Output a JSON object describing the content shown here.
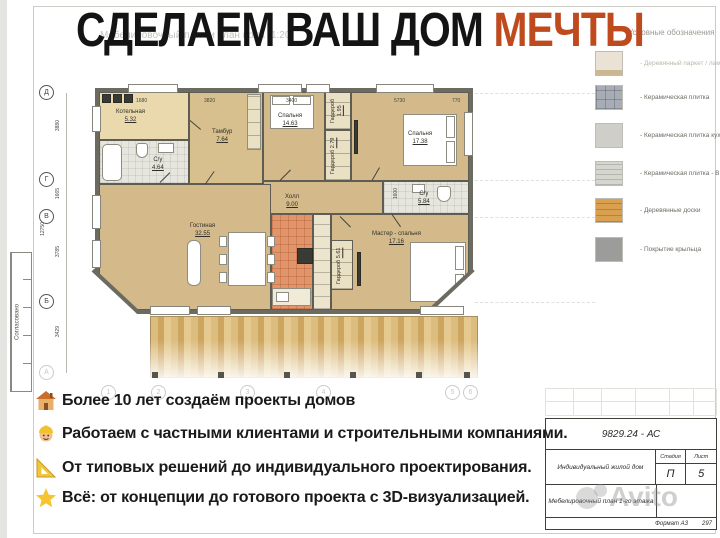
{
  "title": {
    "main": "СДЕЛАЕМ ВАШ ДОМ ",
    "accent": "МЕЧТЫ"
  },
  "drawing_caption": "Мебелировочный план и план пола (1:20)",
  "legend": {
    "header": "Условные обозначения",
    "items": [
      {
        "label": "- Деревянный паркет / ламинат",
        "color": "#eae2d4"
      },
      {
        "label": "- Керамическая плитка",
        "color": "#a8adb5"
      },
      {
        "label": "- Керамическая плитка кухонная",
        "color": "#cfcec9"
      },
      {
        "label": "- Керамическая плитка - В с/у",
        "color": "#d6d6d1"
      },
      {
        "label": "- Деревянные доски",
        "color": "#d9a04f"
      },
      {
        "label": "- Покрытие крыльца",
        "color": "#9c9c9a"
      }
    ]
  },
  "plan": {
    "axis_rows": [
      "Д",
      "Г",
      "В",
      "Б",
      "А"
    ],
    "axis_cols": [
      "1",
      "2",
      "3",
      "4",
      "5",
      "6"
    ],
    "dims_top": [
      "1680",
      "3820",
      "3400",
      "5730",
      "770"
    ],
    "dims_left": [
      "3880",
      "1665",
      "3785",
      "3429"
    ],
    "dim_total_left": "12750",
    "dim_bath": "1600",
    "rooms": [
      {
        "name": "Котельная",
        "area": "5.32"
      },
      {
        "name": "С/у",
        "area": "4.64"
      },
      {
        "name": "Тамбур",
        "area": "7.64"
      },
      {
        "name": "Спальня",
        "area": "14.63"
      },
      {
        "name": "Гардероб",
        "area": "1.95"
      },
      {
        "name": "Гардероб",
        "area": "2.79"
      },
      {
        "name": "Спальня",
        "area": "17.38"
      },
      {
        "name": "Холл",
        "area": "9.00"
      },
      {
        "name": "С/у",
        "area": "5.84"
      },
      {
        "name": "Гостиная",
        "area": "32.55"
      },
      {
        "name": "Гардероб",
        "area": "5.61"
      },
      {
        "name": "Мастер - спальня",
        "area": "17.16"
      }
    ]
  },
  "features": [
    {
      "icon": "house-icon",
      "text": "Более 10 лет создаём проекты домов"
    },
    {
      "icon": "worker-icon",
      "text": "Работаем с частными клиентами и строительными компаниями."
    },
    {
      "icon": "ruler-icon",
      "text": "От типовых решений до индивидуального проектирования."
    },
    {
      "icon": "star-icon",
      "text": "Всё: от концепции до готового проекта с 3D-визуализацией."
    }
  ],
  "title_block": {
    "doc_number": "9829.24 - АС",
    "project": "Индивидуальный жилой дом",
    "stage_label": "Стадия",
    "stage_value": "П",
    "sheet_label": "Лист",
    "sheet_value": "5",
    "sheet_title": "Мебелировочный план 1-го этажа",
    "format_label": "Формат А3",
    "format_size": "297"
  },
  "approve_label": "Согласовано",
  "watermark": "Avito",
  "accent_color": "#bf4a1e"
}
